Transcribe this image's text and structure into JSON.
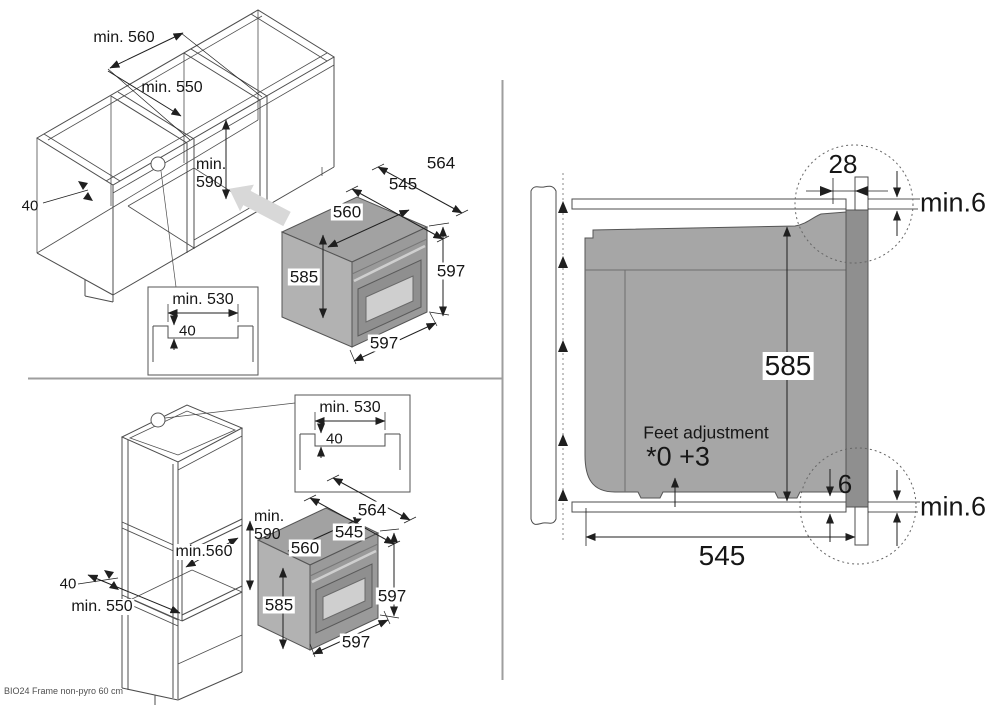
{
  "palette": {
    "line_art": "#4d4d4d",
    "dimension": "#1f1f1f",
    "oven_body_gray": "#a6a6a6",
    "oven_front_gray": "#9a9a9a",
    "oven_frame_gray": "#8f8f8f",
    "door_window_gray": "#cfcfcf",
    "insert_arrow_gray": "#d8d8d8",
    "divider_gray": "#9e9e9e"
  },
  "base_cabinet": {
    "niche_width": "min. 560",
    "niche_depth": "min. 550",
    "niche_height_line1": "min.",
    "niche_height_line2": "590",
    "front_rail_width": "40",
    "inset": {
      "width": "min. 530",
      "depth": "40"
    },
    "oven": {
      "depth_total": "564",
      "depth_body": "545",
      "width_body": "560",
      "height_body": "585",
      "height_front": "597",
      "width_front": "597"
    }
  },
  "tall_cabinet": {
    "niche_width": "min.560",
    "niche_depth": "min. 550",
    "niche_height_line1": "min.",
    "niche_height_line2": "590",
    "front_rail_width": "40",
    "inset": {
      "width": "min. 530",
      "depth": "40"
    },
    "oven": {
      "depth_total": "564",
      "depth_body": "545",
      "width_body": "560",
      "height_body": "585",
      "height_front": "597",
      "width_front": "597"
    }
  },
  "side_section": {
    "top_overlap": "28",
    "top_gap": "min.6",
    "body_height": "585",
    "feet_label": "Feet adjustment",
    "feet_values": "*0 +3",
    "bottom_front_gap": "6",
    "bottom_gap": "min.6",
    "body_depth": "545"
  },
  "footer": {
    "model_note": "BIO24 Frame non-pyro 60 cm"
  }
}
